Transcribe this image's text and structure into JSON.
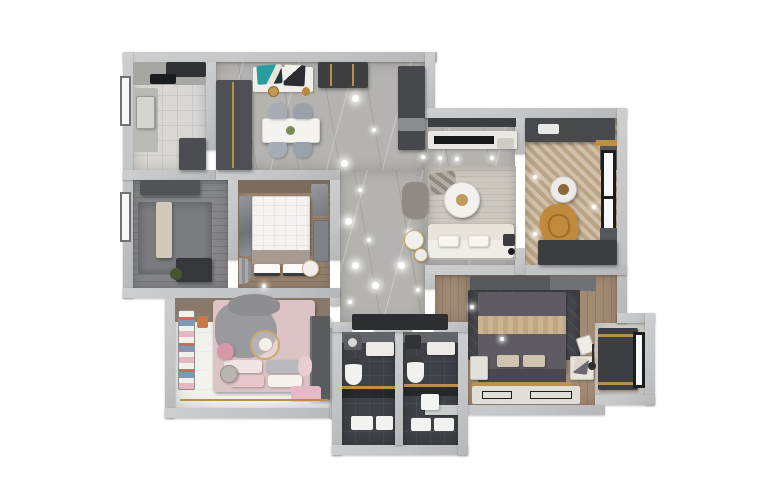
{
  "scene": {
    "type": "3d-apartment-floor-plan-render",
    "rooms": {
      "kitchen": {
        "name": "Kitchen"
      },
      "dining": {
        "name": "Dining Room"
      },
      "hallway": {
        "name": "Entry Hallway"
      },
      "study": {
        "name": "Study"
      },
      "master_bedroom": {
        "name": "Master Bedroom"
      },
      "kids_bedroom": {
        "name": "Kids Bedroom"
      },
      "bathroom_left": {
        "name": "Bathroom 1"
      },
      "bathroom_right": {
        "name": "Bathroom 2"
      },
      "living_room": {
        "name": "Living Room"
      },
      "balcony": {
        "name": "Balcony Lounge"
      },
      "bedroom2": {
        "name": "Second Bedroom"
      },
      "bay_window": {
        "name": "Bay Window Nook"
      }
    },
    "colors": {
      "wall": "#c3c4c6",
      "kitchen_floor": "#d8d7d3",
      "marble_floor": "#b5b3af",
      "study_floor": "#85868a",
      "master_wood_floor": "#98836f",
      "kids_floor": "#edece8",
      "bathroom_floor": "#3e4145",
      "bedroom2_wood_floor": "#a18a74",
      "herringbone_floor": "#c6b092",
      "bay_floor": "#dad7d1",
      "sofa": "#e8e4db",
      "master_bed": "#f4f3f1",
      "kids_bed": "#dcc3c6",
      "bed2": "#5e5c62",
      "lounge_chair": "#c08a3c",
      "pouf_pink": "#d697a8",
      "accent_gold": "#b98f4a",
      "accent_teal": "#2a9d9f",
      "cabinet_dark": "#46484c",
      "doormat_dark": "#2c2e31"
    },
    "furniture": {
      "window": "Window",
      "kitchen_sink": "Kitchen Sink",
      "stove": "Cooktop and Hood",
      "fridge": "Refrigerator Cabinet",
      "wine_cabinet": "Tall Wine Cabinet",
      "sideboard": "Sideboard with Artwork",
      "dining_table": "Dining Table",
      "dining_chair": "Dining Chair",
      "entry_cabinet": "Entry Cabinet",
      "doormat": "Doormat",
      "spotlight": "Ceiling Spotlight",
      "study_desk": "Desk",
      "study_cabinet": "Storage Cabinet",
      "rug": "Area Rug",
      "master_bed": "Double Bed with White Duvet",
      "wardrobe": "Wardrobe",
      "nightstand": "Nightstand",
      "curtain": "Curtain",
      "mirror_panel": "Mirror Panel",
      "kids_bed": "Kids Bed with Pink Bedding",
      "kids_shelf": "Striped Toy Shelf",
      "pouf": "Pink Pouf",
      "side_table": "Side Table",
      "plush_toy": "Plush Toy",
      "toilet": "Toilet",
      "vanity": "Vanity Basin",
      "corner_sink": "Corner Washbasin",
      "shower_glass": "Glass Shower Partition",
      "bath_mat": "Bath Mat",
      "tv_console": "TV Media Console",
      "tv": "Television",
      "coffee_table": "Round Coffee Table",
      "sofa": "Fabric Sofa",
      "armchair": "Accent Armchair",
      "floor_lamp": "Floor Lamp",
      "lounge_chair": "Mustard Lounge Chair",
      "balcony_cabinet": "Balcony Cabinet",
      "bed2": "Platform Bed with Grey Duvet",
      "desk2": "Writing Desk",
      "desk_chair": "Desk Chair",
      "window_seat": "Window Seat",
      "artwork": "Leaning Artwork",
      "walkway_rug": "Bedside Runner"
    }
  }
}
